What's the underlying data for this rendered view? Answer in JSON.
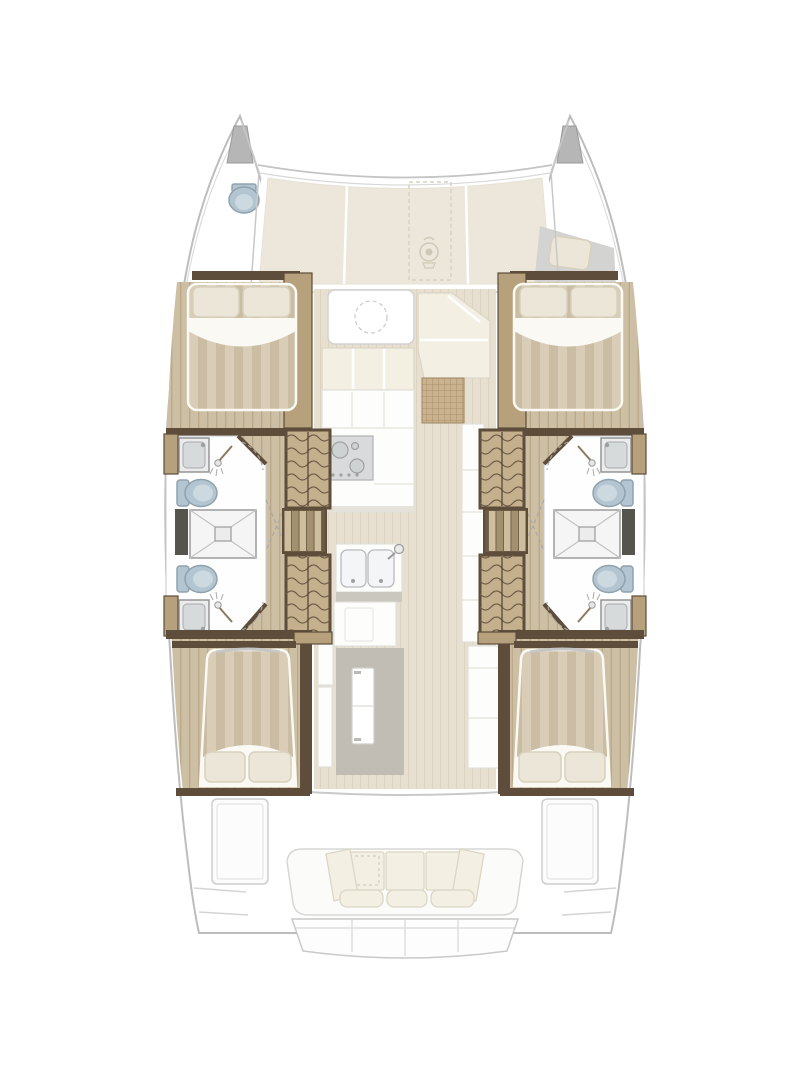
{
  "palette": {
    "outline": "#bdbdbd",
    "wall": "#5d4d3a",
    "woodTrim": "#b7a17c",
    "hullFloor": "#cdbfa3",
    "hullFloorLine": "#bba98a",
    "salonFloor": "#e7e0d1",
    "salonFloorLine": "#dcd3c0",
    "sunpad": "#ece7da",
    "stripeA": "#d9cdb7",
    "stripeB": "#cabda3",
    "sheet": "#faf9f4",
    "pillow": "#ece6d8",
    "pillowEdge": "#d7d0bd",
    "wardrobe": "#c4b08c",
    "wavyLine": "#6f5e47",
    "stairLight": "#cfbe9d",
    "stairDark": "#a3906f",
    "stairBase": "#6b5b45",
    "toilet": "#b3c5d0",
    "toiletEdge": "#8fa2ad",
    "toiletInner": "#cdd9e0",
    "fixture": "#d7dadb",
    "cooktop": "#d9dadb",
    "wicker": "#c9b28d",
    "wickerLine": "#a8906a",
    "doorGray": "#c1bdb4",
    "slab": "#55544f",
    "bench": "#f3efe3",
    "benchEdge": "#dcd6c6",
    "grayPad": "#d3d3d2"
  },
  "diagram": {
    "type": "floorplan",
    "subject": "catamaran sailing yacht accommodation plan, top view",
    "orientation": "bow-up",
    "zones": [
      {
        "id": "port-bow",
        "fixtures": [
          "bow-tip",
          "forepeak-toilet"
        ]
      },
      {
        "id": "starboard-bow",
        "fixtures": [
          "bow-tip",
          "forepeak-berth-cushion"
        ]
      },
      {
        "id": "foredeck",
        "fixtures": [
          "sunpad-cushions",
          "dashed-hatch-outline",
          "windlass-emblem"
        ]
      },
      {
        "id": "salon",
        "fixtures": [
          "dinette-table",
          "settee",
          "wicker-mat",
          "galley-counter",
          "cooktop",
          "double-sink",
          "island-unit",
          "sliding-door"
        ]
      },
      {
        "id": "port-forward-cabin",
        "fixtures": [
          "double-berth",
          "pillows",
          "wardrobe"
        ]
      },
      {
        "id": "starboard-forward-cabin",
        "fixtures": [
          "double-berth",
          "pillows",
          "wardrobe"
        ]
      },
      {
        "id": "port-bathroom",
        "fixtures": [
          "washbasin",
          "toilet",
          "shower",
          "toilet",
          "washbasin"
        ]
      },
      {
        "id": "starboard-bathroom",
        "fixtures": [
          "washbasin",
          "toilet",
          "shower",
          "toilet",
          "washbasin"
        ]
      },
      {
        "id": "port-companionway",
        "fixtures": [
          "stairs",
          "wardrobes"
        ]
      },
      {
        "id": "starboard-companionway",
        "fixtures": [
          "stairs",
          "wardrobes"
        ]
      },
      {
        "id": "port-aft-cabin",
        "fixtures": [
          "double-berth",
          "pillows"
        ]
      },
      {
        "id": "starboard-aft-cabin",
        "fixtures": [
          "double-berth",
          "pillows"
        ]
      },
      {
        "id": "cockpit",
        "fixtures": [
          "bench-sofa",
          "back-cushions",
          "bolster-pillows",
          "seat-cushions",
          "side-lockers"
        ]
      },
      {
        "id": "transom",
        "fixtures": [
          "swim-steps"
        ]
      }
    ]
  }
}
